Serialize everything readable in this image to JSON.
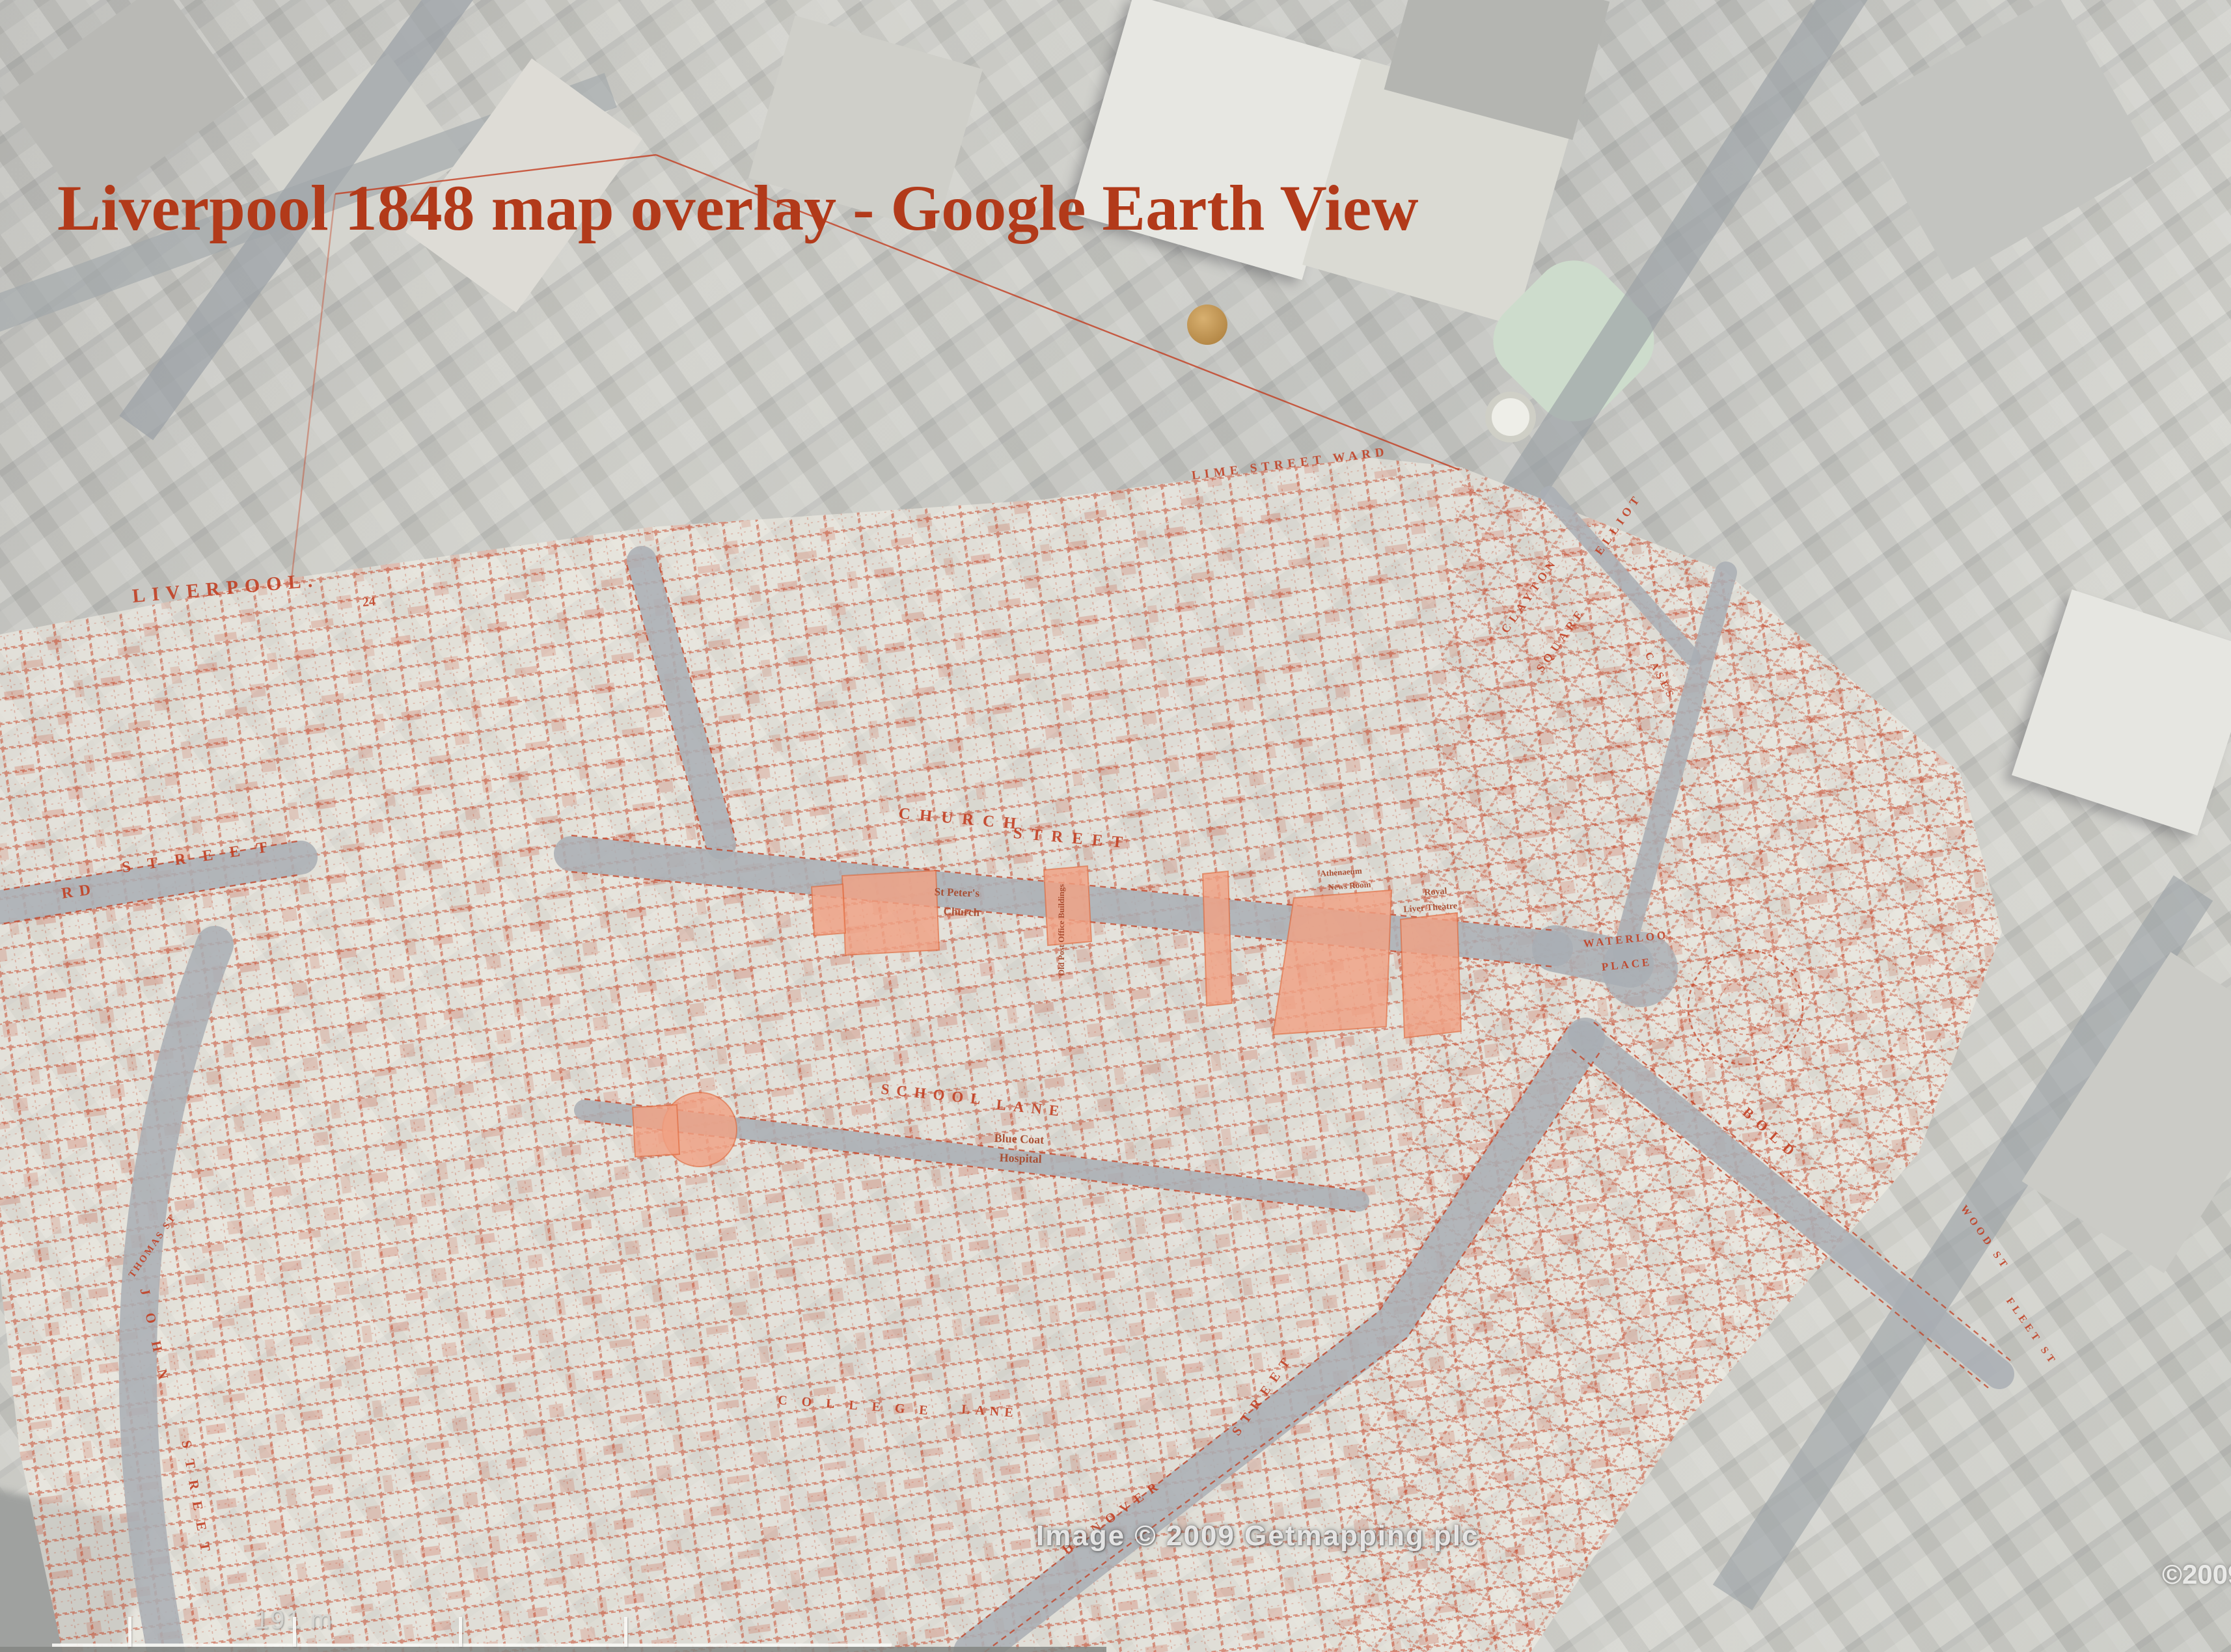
{
  "title": {
    "text": "Liverpool 1848 map overlay - Google Earth View"
  },
  "watermark": {
    "image_credit": "Image © 2009 Getmapping plc",
    "partial_copyright": "©2009"
  },
  "scale": {
    "label": "191 m"
  },
  "colors": {
    "title_red": "#b23a1a",
    "overlay_line_red": "#c33d20",
    "highlight_salmon": "#f0a184",
    "satellite_gray": "#c6c6c2",
    "street_corridor": "#a9aeb4",
    "garden_green": "#cddccc"
  },
  "map_labels": {
    "liverpool": "LIVERPOOL.",
    "sheet_number": "24",
    "lime_street_ward": "LIME STREET WARD",
    "church": "CHURCH",
    "street_a": "STREET",
    "school": "SCHOOL",
    "lane": "LANE",
    "lord_rd": "RD",
    "street_b": "STREET",
    "bold": "BOLD",
    "waterloo": "WATERLOO",
    "place": "PLACE",
    "clayton": "CLAYTON",
    "square": "SQUARE",
    "elliot": "ELLIOT",
    "cases": "CASES",
    "st_peters_1": "St Peter's",
    "st_peters_2": "Church",
    "blue_coat_1": "Blue Coat",
    "blue_coat_2": "Hospital",
    "athenaeum_1": "Athenaeum",
    "athenaeum_2": "News Room",
    "royal_1": "Royal",
    "royal_2": "Liver Theatre",
    "old_post_office": "Old Post Office Buildings",
    "john": "JOHN",
    "street_c": "STREET",
    "thomas": "THOMAS ST",
    "college": "COLLEGE",
    "lane_2": "LANE",
    "hanover": "HANOVER",
    "street_d": "STREET",
    "wood": "WOOD ST",
    "fleet": "FLEET ST"
  }
}
